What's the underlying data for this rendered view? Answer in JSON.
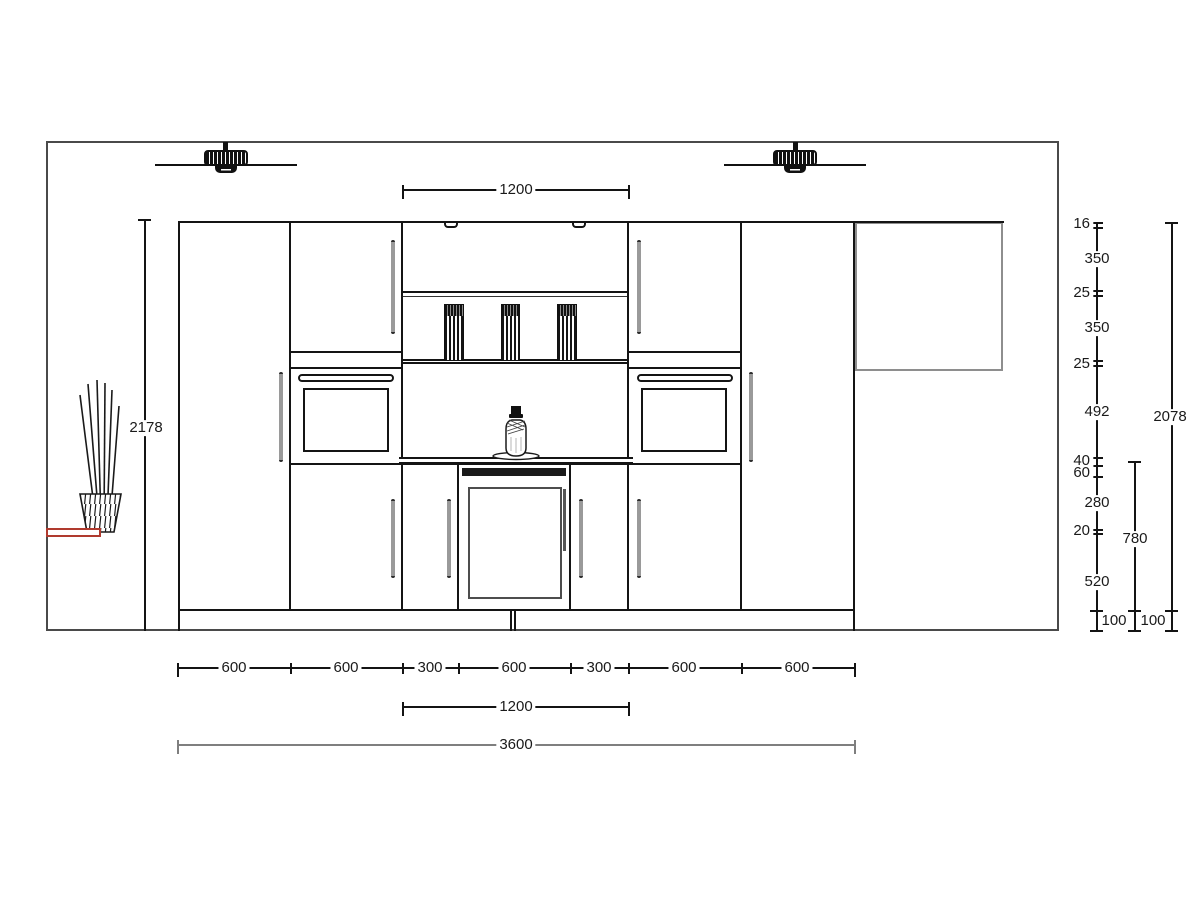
{
  "drawing": {
    "title": "kitchen-elevation-cad-view",
    "objects": {
      "wall": "room wall outline",
      "lights": [
        "ceiling-light",
        "ceiling-light"
      ],
      "plant": "floor vase with sticks",
      "socket": "wall outlet marker",
      "cabinets": [
        "tall-cabinet",
        "wall-cabinet-oven-column",
        "base-300",
        "open-shelf-unit-with-wine-cooler",
        "base-300",
        "wall-cabinet-oven-column",
        "tall-cabinet"
      ],
      "panel": "wall panel right",
      "canisters_count": 3,
      "bottle": "decor bottle on counter"
    },
    "colors": {
      "line": "#141414",
      "wall": "#4a4a4a",
      "dim_gray": "#7f7f7f",
      "handle": "#9a9a9a",
      "panel_border": "#8e8e8e",
      "socket_red": "#b03a2e",
      "background": "#ffffff"
    }
  },
  "dims": {
    "top_width": "1200",
    "left_total_height": "2178",
    "right_total_height": "2078",
    "right_stack": [
      "16",
      "350",
      "25",
      "350",
      "25",
      "492",
      "40",
      "60",
      "280",
      "20",
      "520",
      "100"
    ],
    "base_unit_height": "780",
    "base_plinth": "100",
    "bottom_segments": [
      "600",
      "600",
      "300",
      "600",
      "300",
      "600",
      "600"
    ],
    "bottom_center_width": "1200",
    "bottom_total_width": "3600"
  }
}
